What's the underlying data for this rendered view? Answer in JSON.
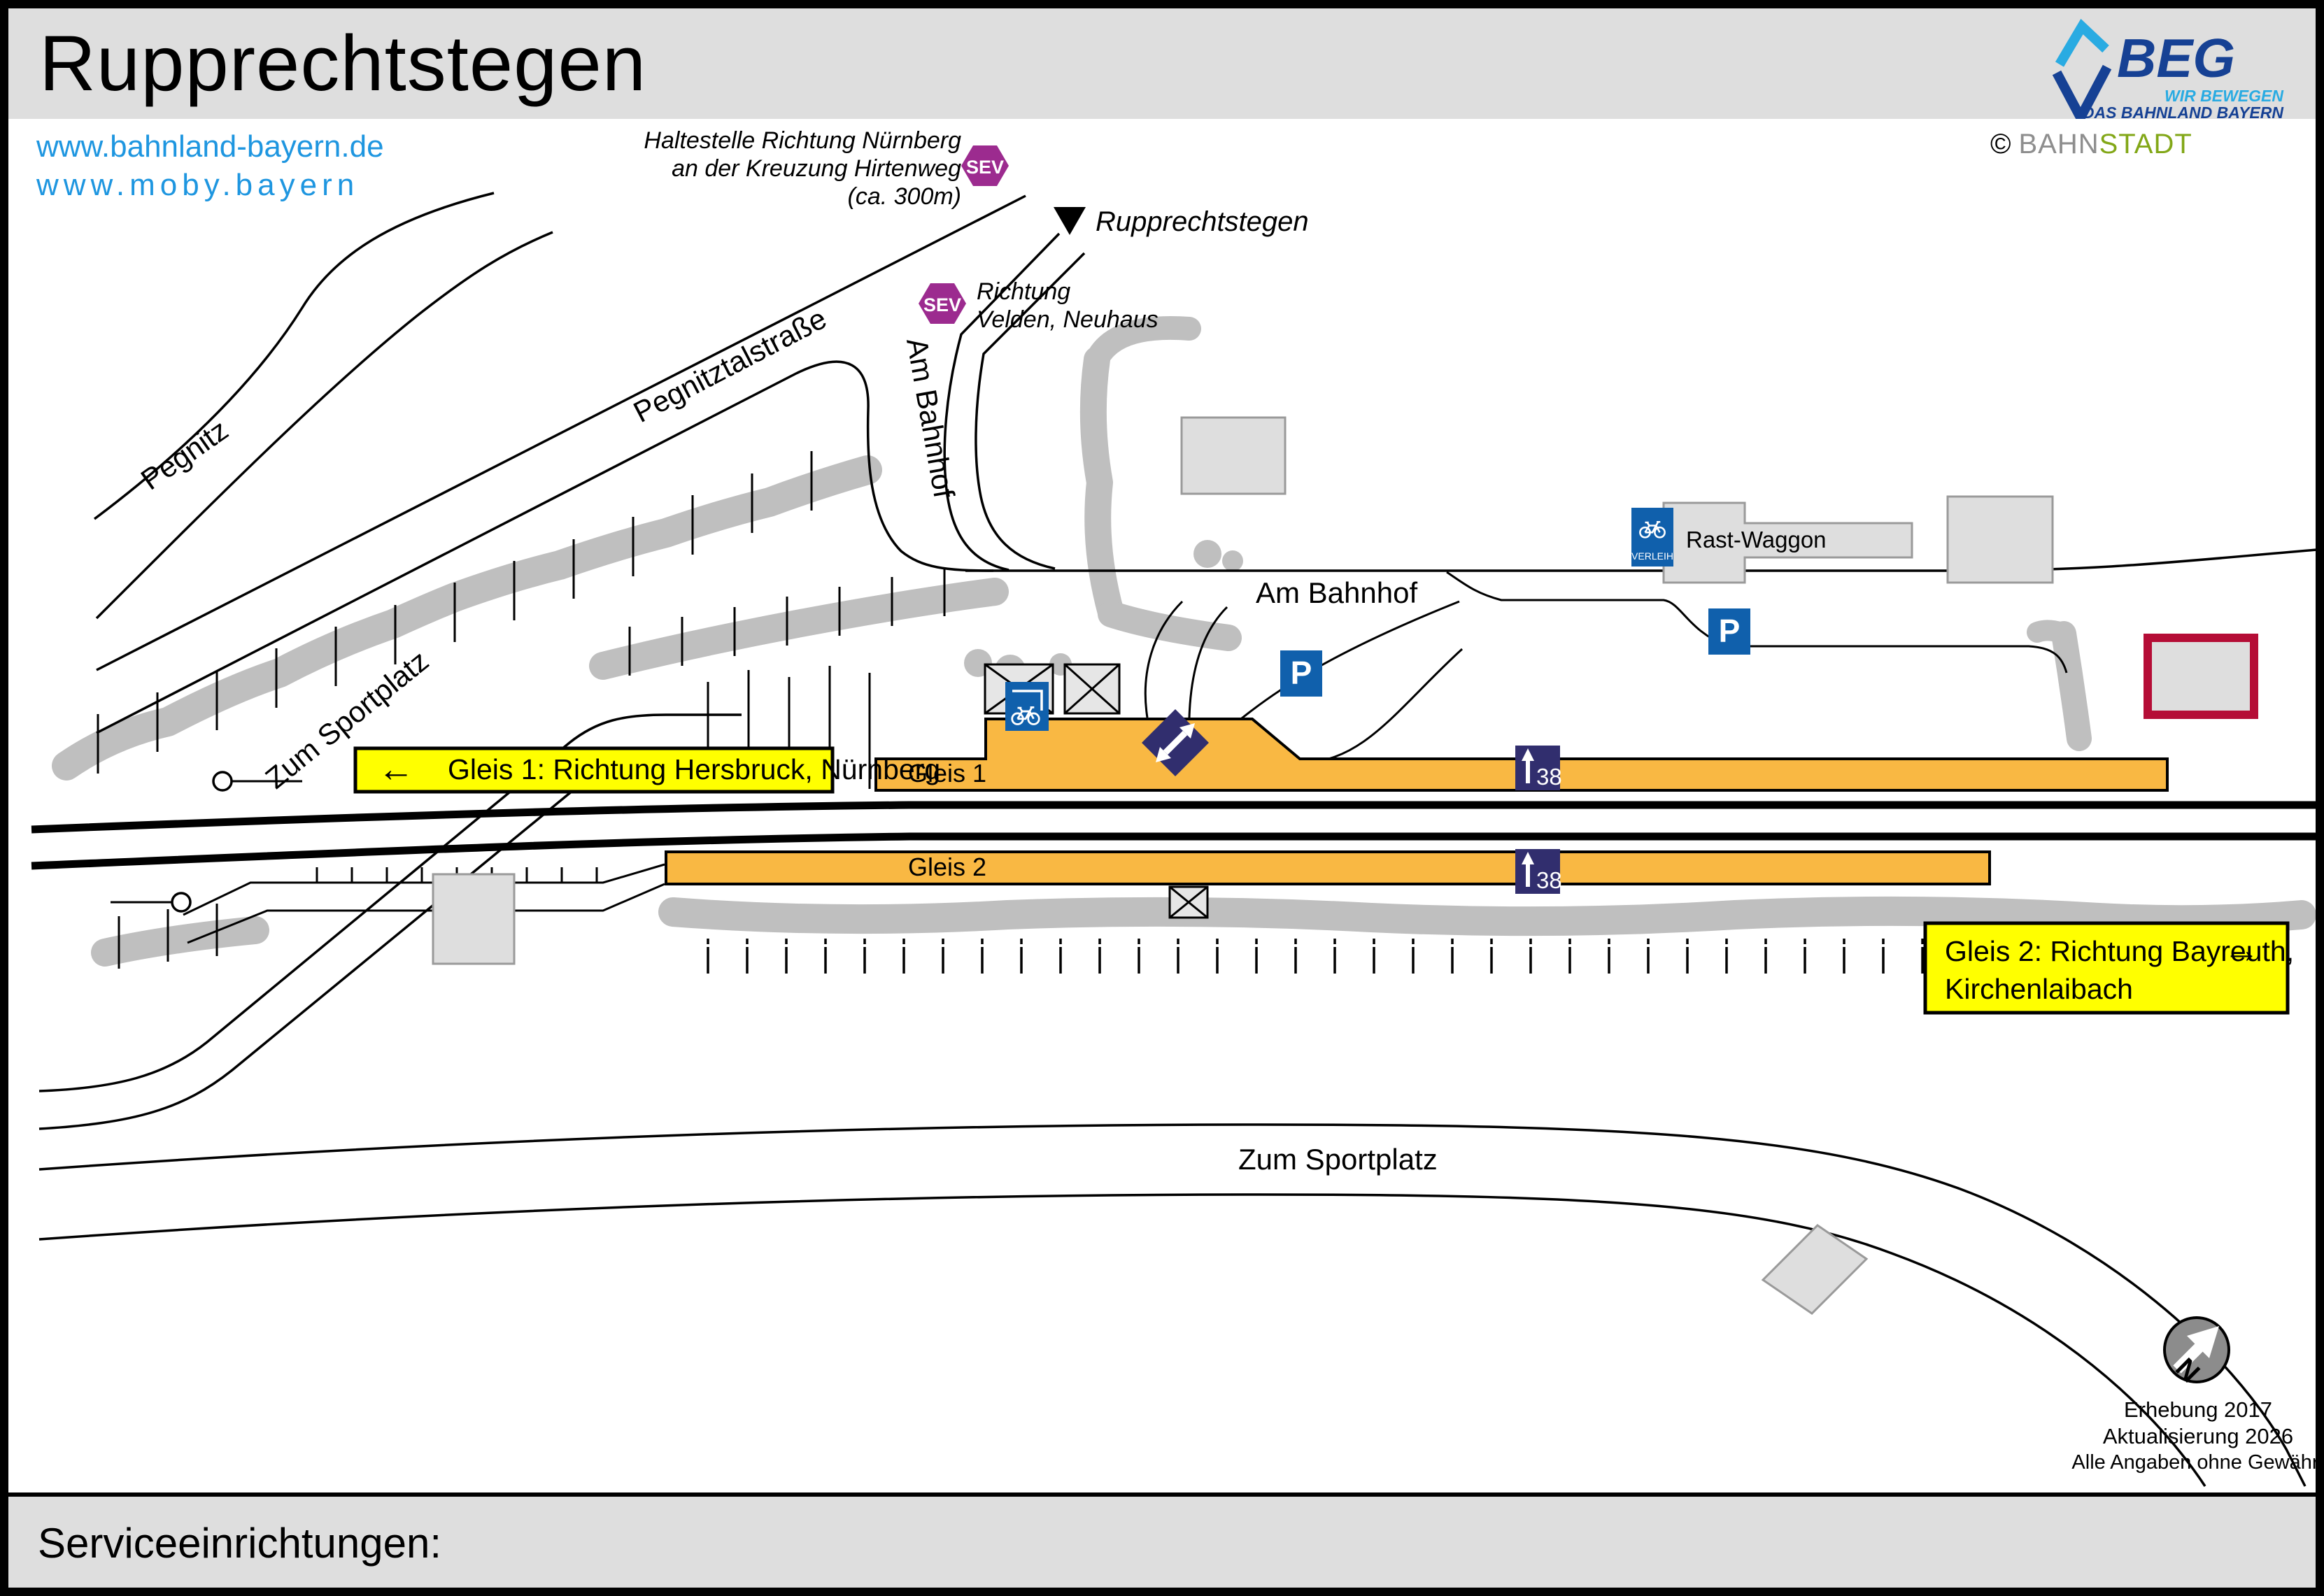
{
  "page": {
    "title": "Rupprechtstegen"
  },
  "links": {
    "line1": "www.bahnland-bayern.de",
    "line2": "www.moby.bayern"
  },
  "branding": {
    "beg": "BEG",
    "claim_line1": "WIR BEWEGEN",
    "claim_line2": "DAS BAHNLAND BAYERN",
    "copyright": "©",
    "bahn": "BAHN",
    "stadt": "STADT"
  },
  "map": {
    "sev_badge": "SEV",
    "sev_stop_nuernberg": {
      "line1": "Haltestelle Richtung Nürnberg",
      "line2": "an der Kreuzung Hirtenweg",
      "line3": "(ca. 300m)"
    },
    "sev_stop_velden": {
      "line1": "Richtung",
      "line2": "Velden, Neuhaus"
    },
    "station_label": "Rupprechtstegen",
    "streets": {
      "pegnitz": "Pegnitz",
      "pegnitztalstrasse": "Pegnitztalstraße",
      "zum_sportplatz": "Zum Sportplatz",
      "am_bahnhof": "Am Bahnhof"
    },
    "rast_waggon": "Rast-Waggon",
    "verleih": "VERLEIH",
    "parking": "P",
    "platform1": {
      "name": "Gleis 1",
      "height": "38"
    },
    "platform2": {
      "name": "Gleis 2",
      "height": "38"
    },
    "sign_gleis1": {
      "arrow": "←",
      "text": "Gleis 1: Richtung Hersbruck, Nürnberg"
    },
    "sign_gleis2": {
      "line1": "Gleis 2: Richtung Bayreuth,",
      "line2": "Kirchenlaibach",
      "arrow": "→"
    },
    "compass": {
      "letter": "N"
    },
    "notes": {
      "line1": "Erhebung 2017",
      "line2": "Aktualisierung 2026",
      "line3": "Alle Angaben ohne Gewähr!"
    }
  },
  "footer": {
    "title": "Serviceeinrichtungen:",
    "icon_verleih_label": "VERLEIH",
    "icon_parking_label": "P"
  },
  "colors": {
    "header_bg": "#DEDEDE",
    "platform_orange": "#F9B843",
    "sign_yellow": "#FFFF00",
    "icon_blue": "#1060AC",
    "marker_navy": "#312E6E",
    "sev_purple": "#9C2B8F",
    "link_blue": "#1E96E0",
    "beg_dark": "#164194",
    "beg_light": "#29ABE2",
    "stadt_green": "#82A717",
    "highlight_red": "#B50D36",
    "building_gray": "#DEDEDE",
    "vegetation_gray": "#BFBFBF"
  }
}
